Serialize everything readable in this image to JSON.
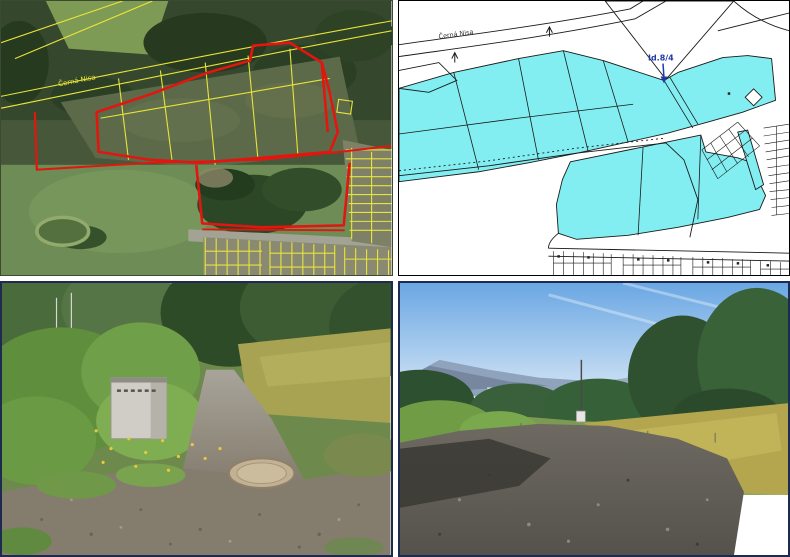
{
  "figure": {
    "layout": "2x2-collage",
    "gutter_color": "#ffffff",
    "panels": {
      "aerial": {
        "name": "aerial-orthophoto-with-cadastral-overlay",
        "stream_label": "Černá Nisa",
        "colors": {
          "parcel_line": "#e9e43a",
          "boundary_line": "#e3150f"
        }
      },
      "cadastre": {
        "name": "cadastral-map-with-highlighted-parcels",
        "stream_label": "Černá Nisa",
        "callout_label": "Id.8/4",
        "colors": {
          "highlight_fill": "#82eef2",
          "line": "#1a1a1a",
          "callout_text": "#2238a8"
        }
      },
      "photo_path": {
        "name": "ground-photo-gravel-path-with-utility-cabinet-and-manhole"
      },
      "photo_road": {
        "name": "ground-photo-gravel-road-meadow-and-mountains"
      }
    }
  }
}
